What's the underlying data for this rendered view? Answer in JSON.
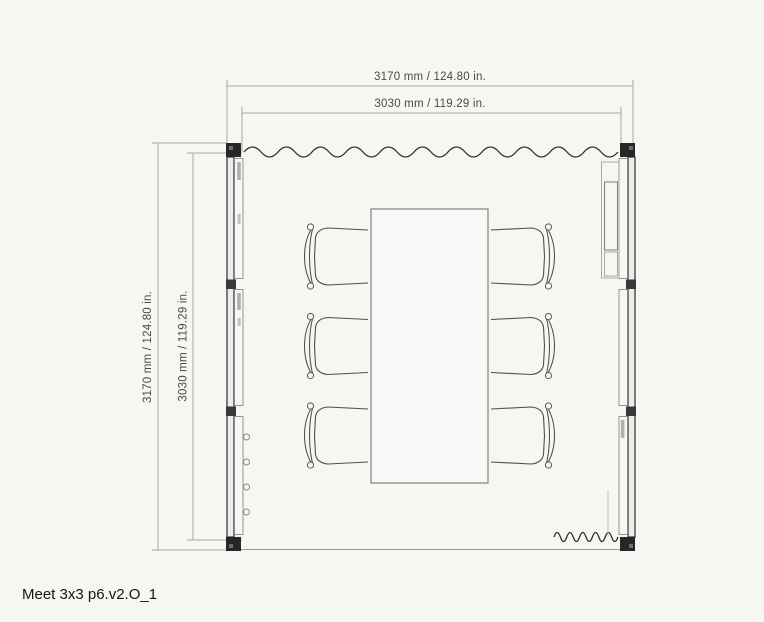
{
  "drawing": {
    "title": "Meet 3x3 p6.v2.O_1",
    "dimensions": {
      "top_outer": "3170 mm / 124.80 in.",
      "top_inner": "3030 mm / 119.29 in.",
      "left_outer": "3170 mm / 124.80 in.",
      "left_inner": "3030 mm / 119.29 in."
    },
    "measurements": [
      {
        "axis": "width",
        "type": "outer",
        "mm": 3170,
        "inches": 124.8
      },
      {
        "axis": "width",
        "type": "inner",
        "mm": 3030,
        "inches": 119.29
      },
      {
        "axis": "depth",
        "type": "outer",
        "mm": 3170,
        "inches": 124.8
      },
      {
        "axis": "depth",
        "type": "inner",
        "mm": 3030,
        "inches": 119.29
      }
    ],
    "contents": {
      "tables": 1,
      "chairs": 6,
      "walls": {
        "top": "curtain",
        "left": "panels-with-hinged-door",
        "right": "panels-with-screen-cabinet",
        "bottom": "open-with-curtain-corner"
      },
      "corner_posts": 4
    },
    "colors": {
      "background": "#f6f6f3",
      "wall_dark": "#2b2b2b",
      "furniture_line": "#4e4e4e",
      "panel_line": "#8a8a8a",
      "dimension_line": "#a8a8a8",
      "dimension_text": "#4a4a4a",
      "title_text": "#151515"
    }
  }
}
